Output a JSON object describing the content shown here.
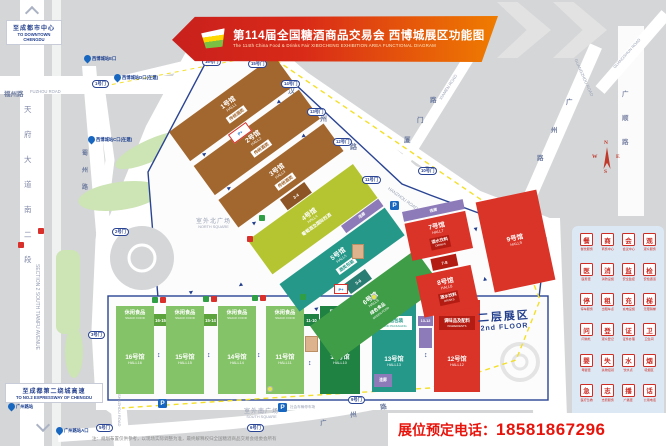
{
  "banner": {
    "title_cn": "第114届全国糖酒商品交易会 西博城展区功能图",
    "title_en": "The 114th China Food & Drinks Fair XIBOCHENG EXHIBITION AREA FUNCTIONAL DIAGRAM"
  },
  "phone": {
    "label": "展位预定电话：",
    "number": "18581867296"
  },
  "footnote": "注：规划布置仅供参考，以现场实际调整为准，最终解释权归全国糖酒商品交易会组委会所有",
  "directions": {
    "to_downtown_cn": "至成都市中心",
    "to_downtown_en": "TO DOWNTOWN CHENGDU",
    "to_expressway_cn": "至成都第二绕城高速",
    "to_expressway_en": "TO NO.2 EXPRESSWAY OF CHENGDU"
  },
  "roads": {
    "fuzhou_cn": "福州路",
    "fuzhou_en": "FUZHOU ROAD",
    "tianfu_chars": [
      "天",
      "府",
      "大",
      "道",
      "南",
      "二",
      "段"
    ],
    "tianfu_en": "SECTION 2 SOUTH TIANFU AVENUE",
    "shuzhou_chars": [
      "蜀",
      "州",
      "路"
    ],
    "shuzhou_en": "SHUZHOU ROAD",
    "hanzhou_chars": [
      "汉",
      "州",
      "路"
    ],
    "hanzhou_en": "HANZHOU ROAD",
    "xiamen_chars": [
      "厦",
      "门",
      "路"
    ],
    "xiamen_en": "XIAMEN ROAD",
    "guangzhou_chars": [
      "广",
      "州",
      "路"
    ],
    "guangzhou_en": "GUANGZHOU ROAD",
    "guangshun_chars": [
      "广",
      "顺",
      "路"
    ],
    "guangshun_en": "GUANGSHUN ROAD"
  },
  "squares": {
    "north_cn": "室外北广场",
    "north_en": "NORTH SQUARE",
    "south_cn": "室外南广场",
    "south_en": "SOUTH SQUARE",
    "parking_note": "社会车辆停车场"
  },
  "floor2": {
    "cn": "二层展区",
    "en": "2nd FLOOR"
  },
  "halls": {
    "h1": {
      "no": "1号馆",
      "en": "HALL1",
      "cat": "传统酒类"
    },
    "h2": {
      "no": "2号馆",
      "en": "HALL2",
      "cat": "传统酒类"
    },
    "h3": {
      "no": "3号馆",
      "en": "HALL3",
      "cat": "传统酒类"
    },
    "h4": {
      "no": "4号馆",
      "en": "HALL4",
      "cat": "葡萄酒及国际烈酒"
    },
    "h5": {
      "no": "5号馆",
      "en": "HALL5",
      "cat": "酒类包装"
    },
    "h6": {
      "no": "6号馆",
      "en": "HALL6",
      "cat": "绿色食品",
      "cat_en": "GREEN FOOD"
    },
    "h7": {
      "no": "7号馆",
      "en": "HALL7",
      "cat": "酒水饮料",
      "cat_en": "DRINKS"
    },
    "h8": {
      "no": "8号馆",
      "en": "HALL8",
      "cat": "酒水饮料",
      "cat_en": "DRINKS"
    },
    "h9": {
      "no": "9号馆",
      "en": "HALL9"
    },
    "h10": {
      "no": "10号馆",
      "en": "HALL10",
      "cat": "国际食品",
      "cat_en": "INTERNATIONAL FOOD"
    },
    "h11": {
      "no": "11号馆",
      "en": "HALL11",
      "cat": "休闲食品",
      "cat_en": "SNACK FOOD"
    },
    "h12": {
      "no": "12号馆",
      "en": "HALL12",
      "cat": "调味品及配料",
      "cat_en": "INGREDIENTS"
    },
    "h13": {
      "no": "13号馆",
      "en": "HALL13",
      "cat": "食品包装",
      "cat_en": "FOOD PACKAGING"
    },
    "h14": {
      "no": "14号馆",
      "en": "HALL14",
      "cat": "休闲食品",
      "cat_en": "SNACK FOOD"
    },
    "h15": {
      "no": "15号馆",
      "en": "HALL15",
      "cat": "休闲食品",
      "cat_en": "SNACK FOOD"
    },
    "h16": {
      "no": "16号馆",
      "en": "HALL16",
      "cat": "休闲食品",
      "cat_en": "SNACK FOOD"
    }
  },
  "connectors": {
    "c34": "3-4",
    "c56": "5-6",
    "c78": "7-8",
    "c1615": "16-15",
    "c1514": "15-14",
    "c1110": "11-10",
    "c1312": "13-12",
    "corridor": "连廊"
  },
  "gates": [
    {
      "label": "1号门",
      "x": 92,
      "y": 80
    },
    {
      "label": "16号门",
      "x": 202,
      "y": 58
    },
    {
      "label": "15号门",
      "x": 248,
      "y": 60
    },
    {
      "label": "14号门",
      "x": 281,
      "y": 80
    },
    {
      "label": "13号门",
      "x": 307,
      "y": 108
    },
    {
      "label": "12号门",
      "x": 333,
      "y": 138
    },
    {
      "label": "11号门",
      "x": 362,
      "y": 176
    },
    {
      "label": "10号门",
      "x": 418,
      "y": 167
    },
    {
      "label": "2号门",
      "x": 112,
      "y": 228
    },
    {
      "label": "3号门",
      "x": 88,
      "y": 331
    },
    {
      "label": "5号门",
      "x": 96,
      "y": 424
    },
    {
      "label": "6号门",
      "x": 247,
      "y": 424
    },
    {
      "label": "9号门",
      "x": 348,
      "y": 396
    }
  ],
  "metro": [
    {
      "label": "西博城站E口",
      "x": 84,
      "y": 55
    },
    {
      "label": "西博城站D口(在建)",
      "x": 114,
      "y": 74
    },
    {
      "label": "西博城站C口(在建)",
      "x": 88,
      "y": 136
    },
    {
      "label": "广州路站",
      "x": 8,
      "y": 403
    },
    {
      "label": "广州路站A口",
      "x": 56,
      "y": 427
    }
  ],
  "parking": [
    {
      "label": "P",
      "x": 390,
      "y": 201
    },
    {
      "label": "P",
      "x": 158,
      "y": 399
    },
    {
      "label": "P",
      "x": 278,
      "y": 403
    }
  ],
  "compass": {
    "n": "N",
    "e": "E",
    "s": "S",
    "w": "W"
  },
  "legend": {
    "items": [
      {
        "label": "餐饮服务",
        "glyph": "餐",
        "type": "red"
      },
      {
        "label": "商务中心",
        "glyph": "商",
        "type": "red"
      },
      {
        "label": "会议中心",
        "glyph": "会",
        "type": "red"
      },
      {
        "label": "观众服务",
        "glyph": "观",
        "type": "red"
      },
      {
        "label": "医务室",
        "glyph": "医",
        "type": "red"
      },
      {
        "label": "消防设施",
        "glyph": "消",
        "type": "red"
      },
      {
        "label": "安全监控",
        "glyph": "监",
        "type": "red"
      },
      {
        "label": "安检通道",
        "glyph": "检",
        "type": "red"
      },
      {
        "label": "停车服务",
        "glyph": "停",
        "type": "red"
      },
      {
        "label": "出租车点",
        "glyph": "租",
        "type": "red"
      },
      {
        "label": "充电设施",
        "glyph": "充",
        "type": "red"
      },
      {
        "label": "无障碍梯",
        "glyph": "梯",
        "type": "red"
      },
      {
        "label": "问询处",
        "glyph": "问",
        "type": "red"
      },
      {
        "label": "观众登记",
        "glyph": "登",
        "type": "red"
      },
      {
        "label": "证件办理",
        "glyph": "证",
        "type": "red"
      },
      {
        "label": "卫生间",
        "glyph": "卫",
        "type": "red"
      },
      {
        "label": "母婴室",
        "glyph": "婴",
        "type": "red"
      },
      {
        "label": "失物招领",
        "glyph": "失",
        "type": "red"
      },
      {
        "label": "饮水点",
        "glyph": "水",
        "type": "red"
      },
      {
        "label": "吸烟区",
        "glyph": "烟",
        "type": "red"
      },
      {
        "label": "医疗急救",
        "glyph": "急",
        "type": "red"
      },
      {
        "label": "志愿服务",
        "glyph": "志",
        "type": "red"
      },
      {
        "label": "广播室",
        "glyph": "播",
        "type": "red"
      },
      {
        "label": "公用电话",
        "glyph": "话",
        "type": "red"
      },
      {
        "label": "AED",
        "glyph": "AED",
        "type": "red"
      },
      {
        "label": "地铁站",
        "glyph": "M",
        "type": "blue"
      },
      {
        "label": "停车场",
        "glyph": "P",
        "type": "blue"
      },
      {
        "label": "机场巴士",
        "glyph": "✈",
        "type": "blue"
      }
    ]
  }
}
